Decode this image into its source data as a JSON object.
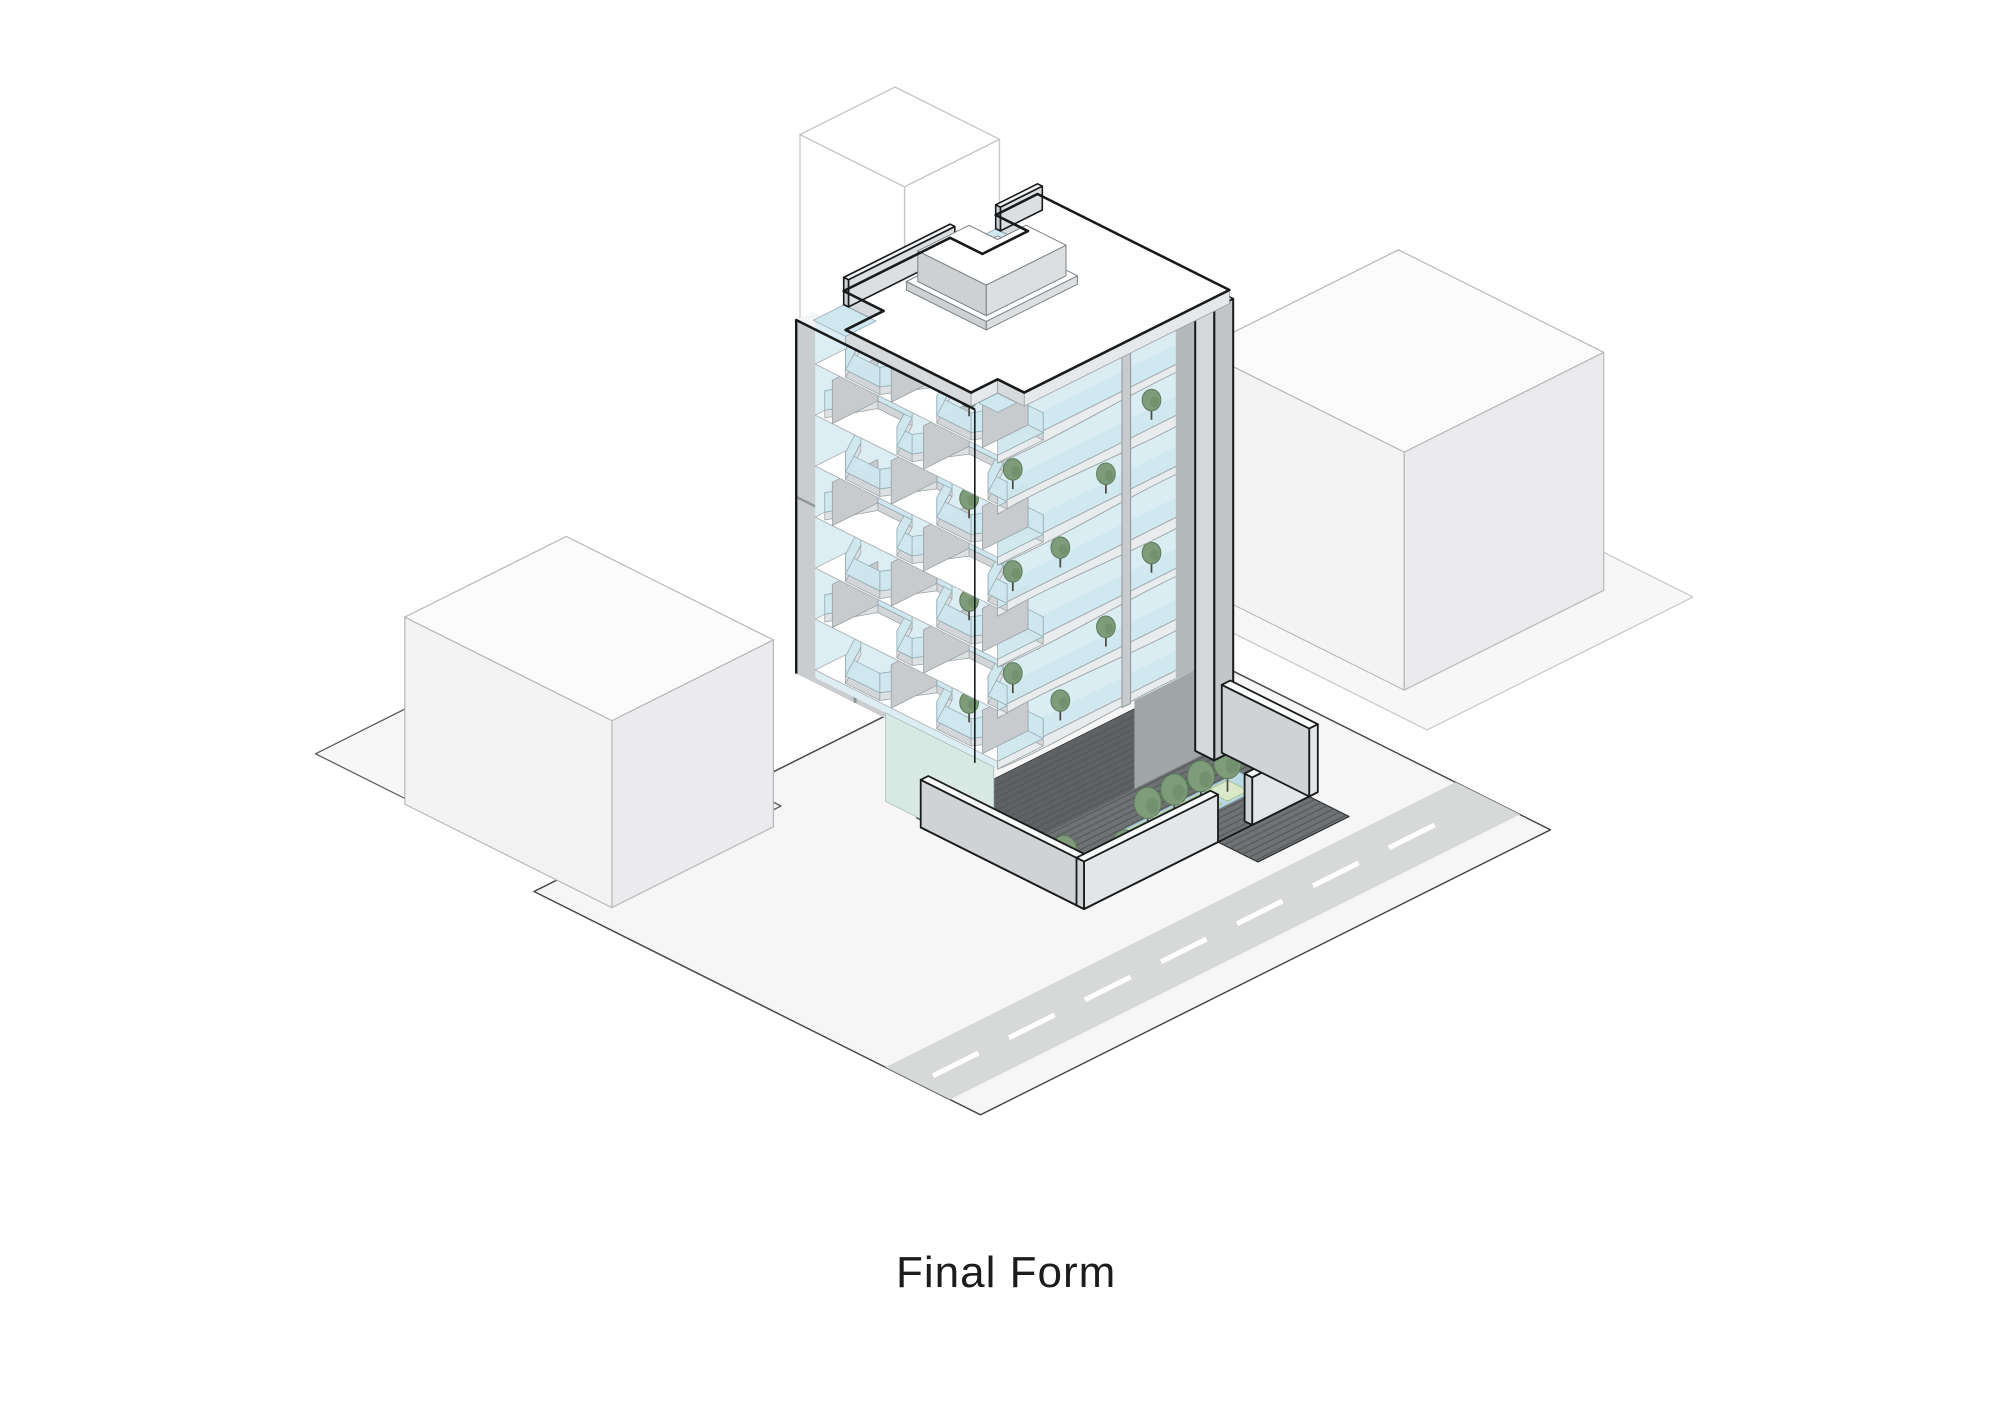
{
  "caption": "Final Form",
  "scene": {
    "type": "isometric-architectural-massing-diagram",
    "description": "Axonometric illustration of a mid-rise residential tower with wavy stacked balcony slabs, glass guardrails and trees on balconies, a gray party wall, a paved courtyard plaza with linear water feature and planters, low perimeter walls, neighboring context buildings and a street with dashed center line.",
    "main_building": {
      "balcony_floors": 7,
      "balcony_trees": 13,
      "roof_elements": [
        "stair-bulkhead",
        "parapet-glass",
        "roof-notches"
      ]
    },
    "courtyard": {
      "paving": "striped plaza",
      "water_feature_planters": 4,
      "lawn_trees": 2
    },
    "context_buildings": [
      "left-neighbor-block",
      "right-neighbor-tower",
      "rear-neighbor-block"
    ],
    "road": {
      "marking": "dashed-center-line"
    }
  },
  "palette": {
    "background": "#ffffff",
    "ground": "#f6f6f7",
    "ground_outline": "#474b4d",
    "quad_fill": "#f7f7f8",
    "quad_outline": "#5a5e60",
    "road": "#d7d8d8",
    "road_dash": "#ffffff",
    "context_top": "#fbfbfc",
    "context_left": "#f3f3f4",
    "context_right": "#ebebed",
    "context_stroke": "#b4b8ba",
    "rear_fill": "#ffffff",
    "rear_stroke": "#c2c6c8",
    "plaza": "#6f7274",
    "plaza_shade": "#5f6264",
    "plaza_stripe": "#545759",
    "plaza_outline": "#2a2d2f",
    "water": "#b9dae3",
    "water_edge": "#8fb6c0",
    "planter": "#d8e8c8",
    "planter_edge": "#a9c292",
    "lawn": "#d5e7c4",
    "lawn_edge": "#b4cd9e",
    "tree_fill": "#7e9c7a",
    "tree_shade": "#68865f",
    "tree_edge": "#5c7a5a",
    "trunk": "#4c463f",
    "glass": "#d9edf3",
    "glass_left": "#dcedf3",
    "rail_glass": "#cfe7ef",
    "rail_edge": "#91a9b1",
    "slab_top": "#ffffff",
    "slab_edge": "#a6acaf",
    "fascia_front": "#e9eced",
    "fascia_left": "#d2d6d8",
    "fascia_diag": "#dde1e3",
    "fascia_stroke": "#9aa0a3",
    "fin": "#c7cbce",
    "fin_edge": "#989ea1",
    "wall_gray": "#c9cdd0",
    "wall_joint": "#8f9598",
    "wall_top": "#f2f4f5",
    "pier_right": "#c2c6c9",
    "pier_left": "#d4d8da",
    "recess": "#b4b9bc",
    "passage": "#a0a5a8",
    "lobby_glass": "#d8e8e2",
    "lobby_edge": "#a8bcb4",
    "roof_top": "#ffffff",
    "roof_fascia_front": "#e6e9eb",
    "roof_fascia_left": "#d6dadc",
    "bulkhead_front": "#dcdfe1",
    "bulkhead_left": "#cdd1d4",
    "bulkhead_stroke": "#7b8184",
    "courtyard_wall_left": "#cfd3d6",
    "courtyard_wall_front": "#e3e6e8",
    "wall_cap": "#fafbfb",
    "outline_bold": "#17191a"
  }
}
